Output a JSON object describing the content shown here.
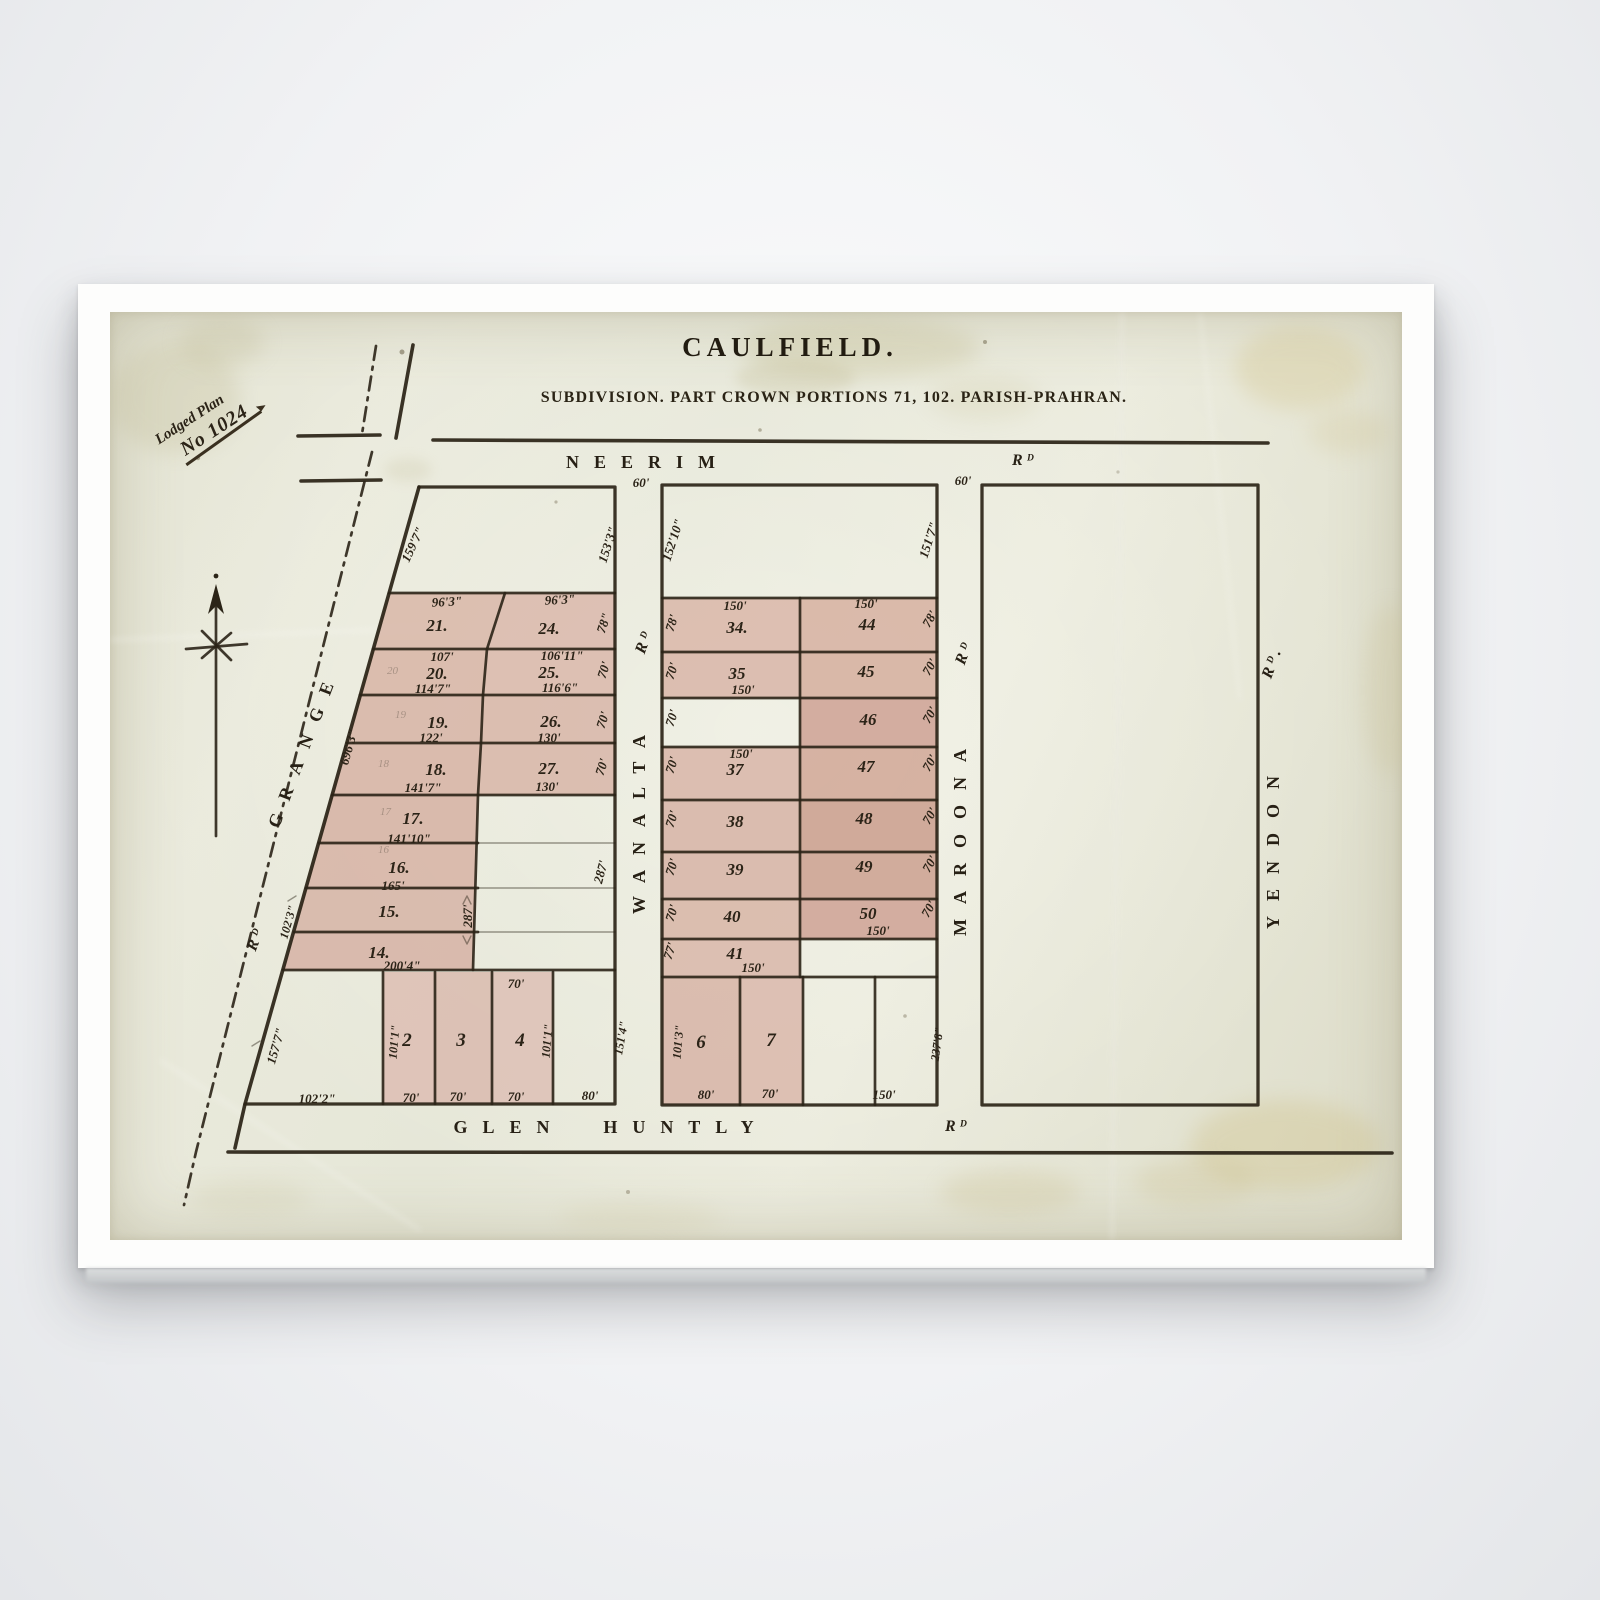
{
  "header": {
    "title": "CAULFIELD.",
    "subtitle": "SUBDIVISION. PART CROWN PORTIONS 71, 102. PARISH-PRAHRAN."
  },
  "stamp": {
    "line1": "Lodged Plan",
    "line2": "No 1024"
  },
  "roads": {
    "neerim": "NEERIM",
    "neerim_sfx": "Rᴰ",
    "glen": "GLEN",
    "huntly": "HUNTLY",
    "glen_sfx": "Rᴰ",
    "grange": "GRANGE",
    "grange_sfx": "Rᴰ",
    "wanalta": "WANALTA",
    "wanalta_sfx": "Rᴰ",
    "maroona": "MAROONA",
    "maroona_sfx": "Rᴰ",
    "yendon": "YENDON",
    "yendon_sfx": "Rᴰ.",
    "wanalta_width": "60'",
    "maroona_width": "60'"
  },
  "labels": {
    "a_nw": "159'7\"",
    "a_ne": "153'3\"",
    "a21": "21.",
    "a21t": "96'3\"",
    "a24": "24.",
    "a24t": "96'3\"",
    "a_r1side": "78\"",
    "a20": "20.",
    "a20t": "107'",
    "a20b": "114'7\"",
    "a25": "25.",
    "a25t": "106'11\"",
    "a25b": "116'6\"",
    "a_r2side": "70'",
    "a19": "19.",
    "a19b": "122'",
    "a26": "26.",
    "a26b": "130'",
    "a_r3side": "70'",
    "a18": "18.",
    "a18b": "141'7\"",
    "a27": "27.",
    "a27b": "130'",
    "a_r4side": "70'",
    "a17": "17.",
    "a17b": "141'10\"",
    "a16": "16.",
    "a16b": "165'",
    "a15": "15.",
    "a14": "14.",
    "a14b": "200'4\"",
    "a_strip_w": "287'",
    "a_strip_e": "287'",
    "a_grange_len": "696'3\"",
    "a_grange_dim": "102'3\"",
    "a_corner_side": "157'7\"",
    "a_corner_b": "102'2\"",
    "a2": "2",
    "a2s": "101'1\"",
    "a2b": "70'",
    "a3": "3",
    "a3b": "70'",
    "a4": "4",
    "a4t": "70'",
    "a4s": "101'1\"",
    "a4b": "70'",
    "a5b": "80'",
    "a5s": "151'4\"",
    "p20": "20",
    "p19": "19",
    "p18": "18",
    "p17": "17",
    "p16": "16",
    "b_nw": "152'10\"",
    "b_ne": "151'7\"",
    "b34": "34.",
    "b34t": "150'",
    "b44": "44",
    "b44t": "150'",
    "b_r1w": "78'",
    "b_r1e": "78'",
    "b35": "35",
    "b35b": "150'",
    "b45": "45",
    "b_r2w": "70'",
    "b_r2e": "70'",
    "b46": "46",
    "b_r3w": "70'",
    "b_r3e": "70'",
    "b37": "37",
    "b37t": "150'",
    "b47": "47",
    "b_r4w": "70'",
    "b_r4e": "70'",
    "b38": "38",
    "b48": "48",
    "b_r5w": "70'",
    "b_r5e": "70'",
    "b39": "39",
    "b49": "49",
    "b_r6w": "70'",
    "b_r6e": "70'",
    "b40": "40",
    "b50": "50",
    "b50b": "150'",
    "b_r7w": "70'",
    "b_r7e": "70'",
    "b41": "41",
    "b41b": "150'",
    "b_r8w": "77'",
    "b6": "6",
    "b6s": "101'3\"",
    "b6b": "80'",
    "b7": "7",
    "b7b": "70'",
    "b_bot": "150'",
    "b_se": "237'8\""
  },
  "colors": {
    "ink": "#2b2417",
    "lot_fill_light": "#dcbcae",
    "lot_fill_mid": "#d7b2a4",
    "lot_fill_dark": "#cda392",
    "paper": "#e8e8d9"
  }
}
